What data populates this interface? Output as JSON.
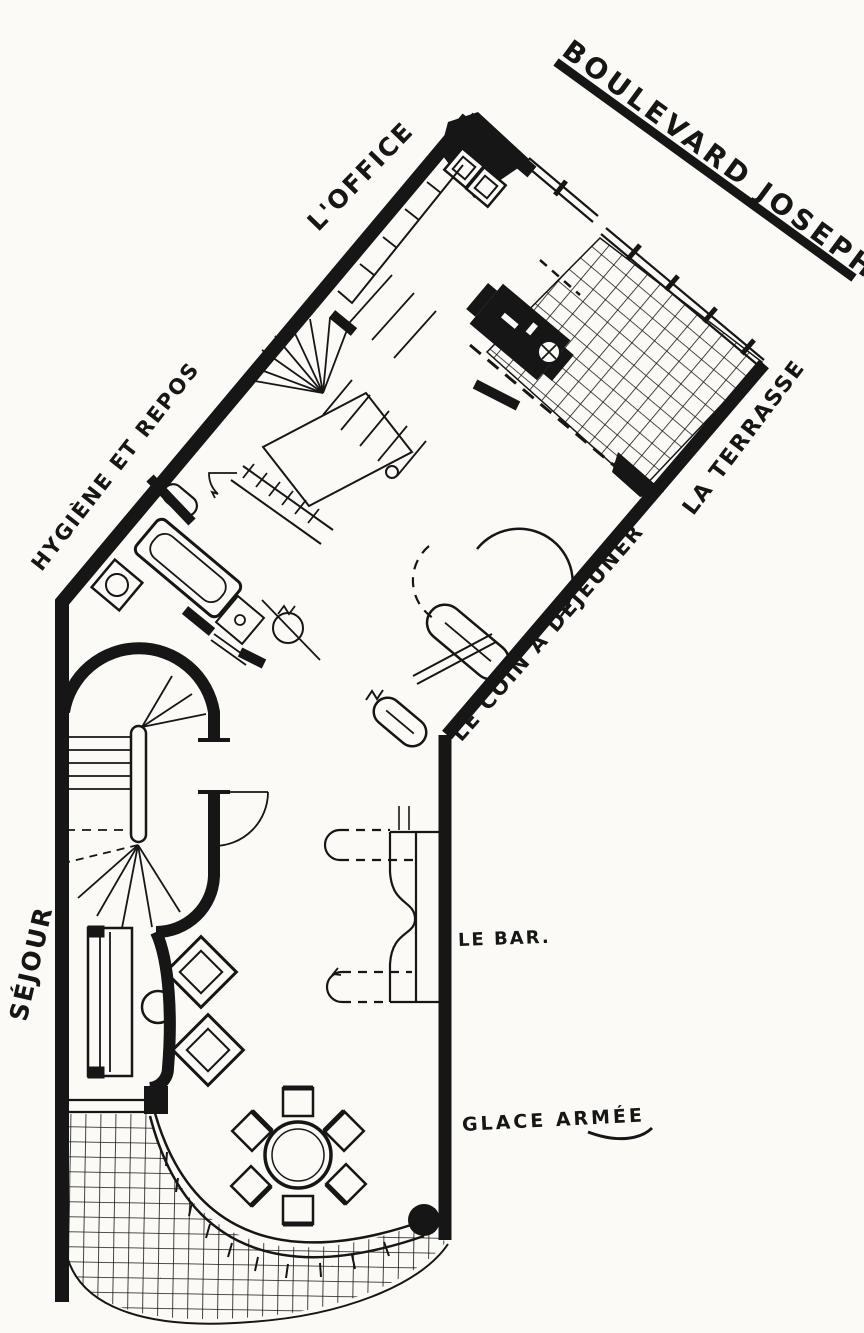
{
  "street": {
    "label": "BOULEVARD JOSEPH II"
  },
  "rooms": {
    "office": {
      "label": "L'OFFICE"
    },
    "hygiene": {
      "label": "HYGIÈNE ET REPOS"
    },
    "terrace": {
      "label": "LA TERRASSE"
    },
    "breakfast": {
      "label": "LE COIN À DÉJEUNER"
    },
    "living": {
      "label": "SÉJOUR"
    }
  },
  "annotations": {
    "bar": {
      "label": "LE BAR."
    },
    "glass": {
      "label": "GLACE ARMÉE"
    }
  },
  "colors": {
    "ink": "#161616",
    "paper": "#fbfaf6"
  }
}
